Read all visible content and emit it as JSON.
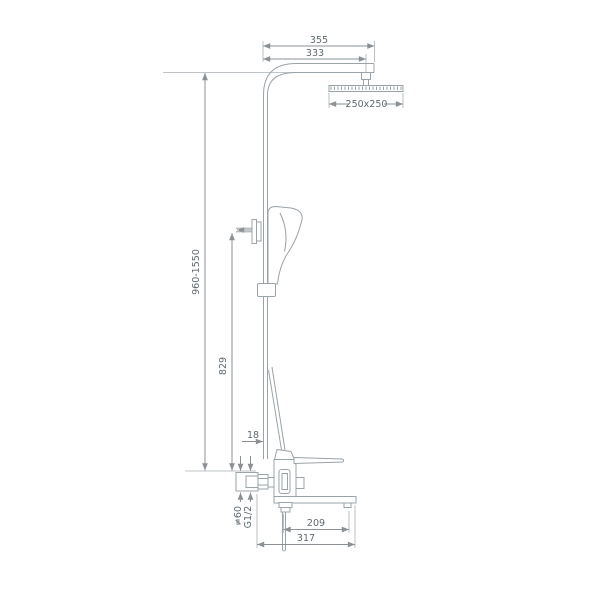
{
  "page": {
    "background": "#ffffff"
  },
  "drawing": {
    "type": "technical-dimension-drawing",
    "line_color": "#9aa3a8",
    "dimension_color": "#8a9094",
    "text_color": "#5f6a70"
  },
  "dimensions": {
    "top_width": "355",
    "head_offset": "333",
    "head_size": "250x250",
    "height_range": "960-1550",
    "riser_height": "829",
    "pipe_offset": "18",
    "spout_reach": "209",
    "overall_depth": "317",
    "flange_diameter": "≠60",
    "thread_size": "G1/2"
  }
}
